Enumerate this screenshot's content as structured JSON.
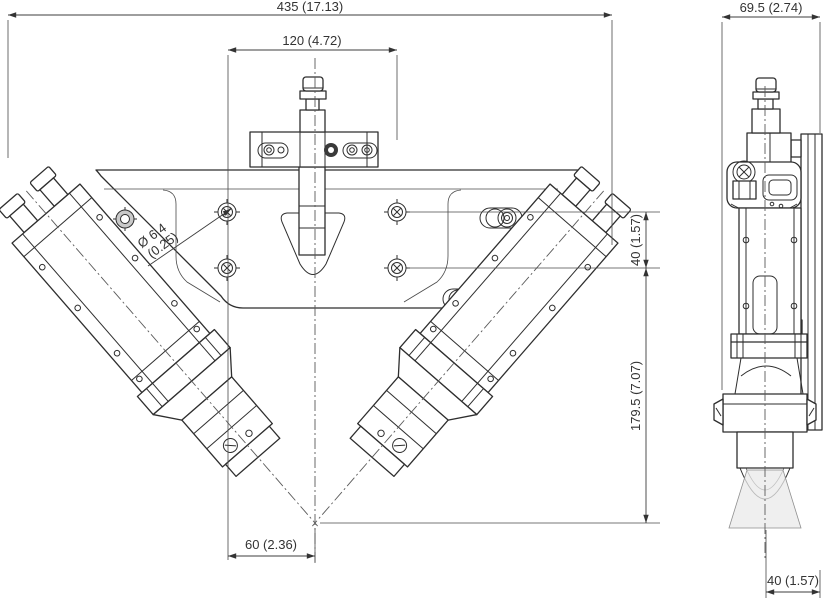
{
  "drawing": {
    "type": "technical-dimension-drawing",
    "views": {
      "front": {
        "name": "front view (Y-shaped twin sensor bracket)"
      },
      "side": {
        "name": "side view (sensor profile with beam)"
      }
    },
    "dimensions": {
      "front_overall_width": "435 (17.13)",
      "front_mount_hole_spacing_x": "120 (4.72)",
      "front_hole_diameter": "Ø 6.4",
      "front_hole_diameter_inch": "(0.25)",
      "front_mount_hole_spacing_y": "40 (1.57)",
      "front_height_to_intersection": "179.5 (7.07)",
      "front_center_offset": "60 (2.36)",
      "side_overall_width": "69.5 (2.74)",
      "side_beam_offset": "40 (1.57)"
    },
    "colors": {
      "line": "#2e2e2e",
      "dimension_text": "#333333",
      "beam_fill": "#e9e9e9",
      "background": "#ffffff"
    }
  }
}
